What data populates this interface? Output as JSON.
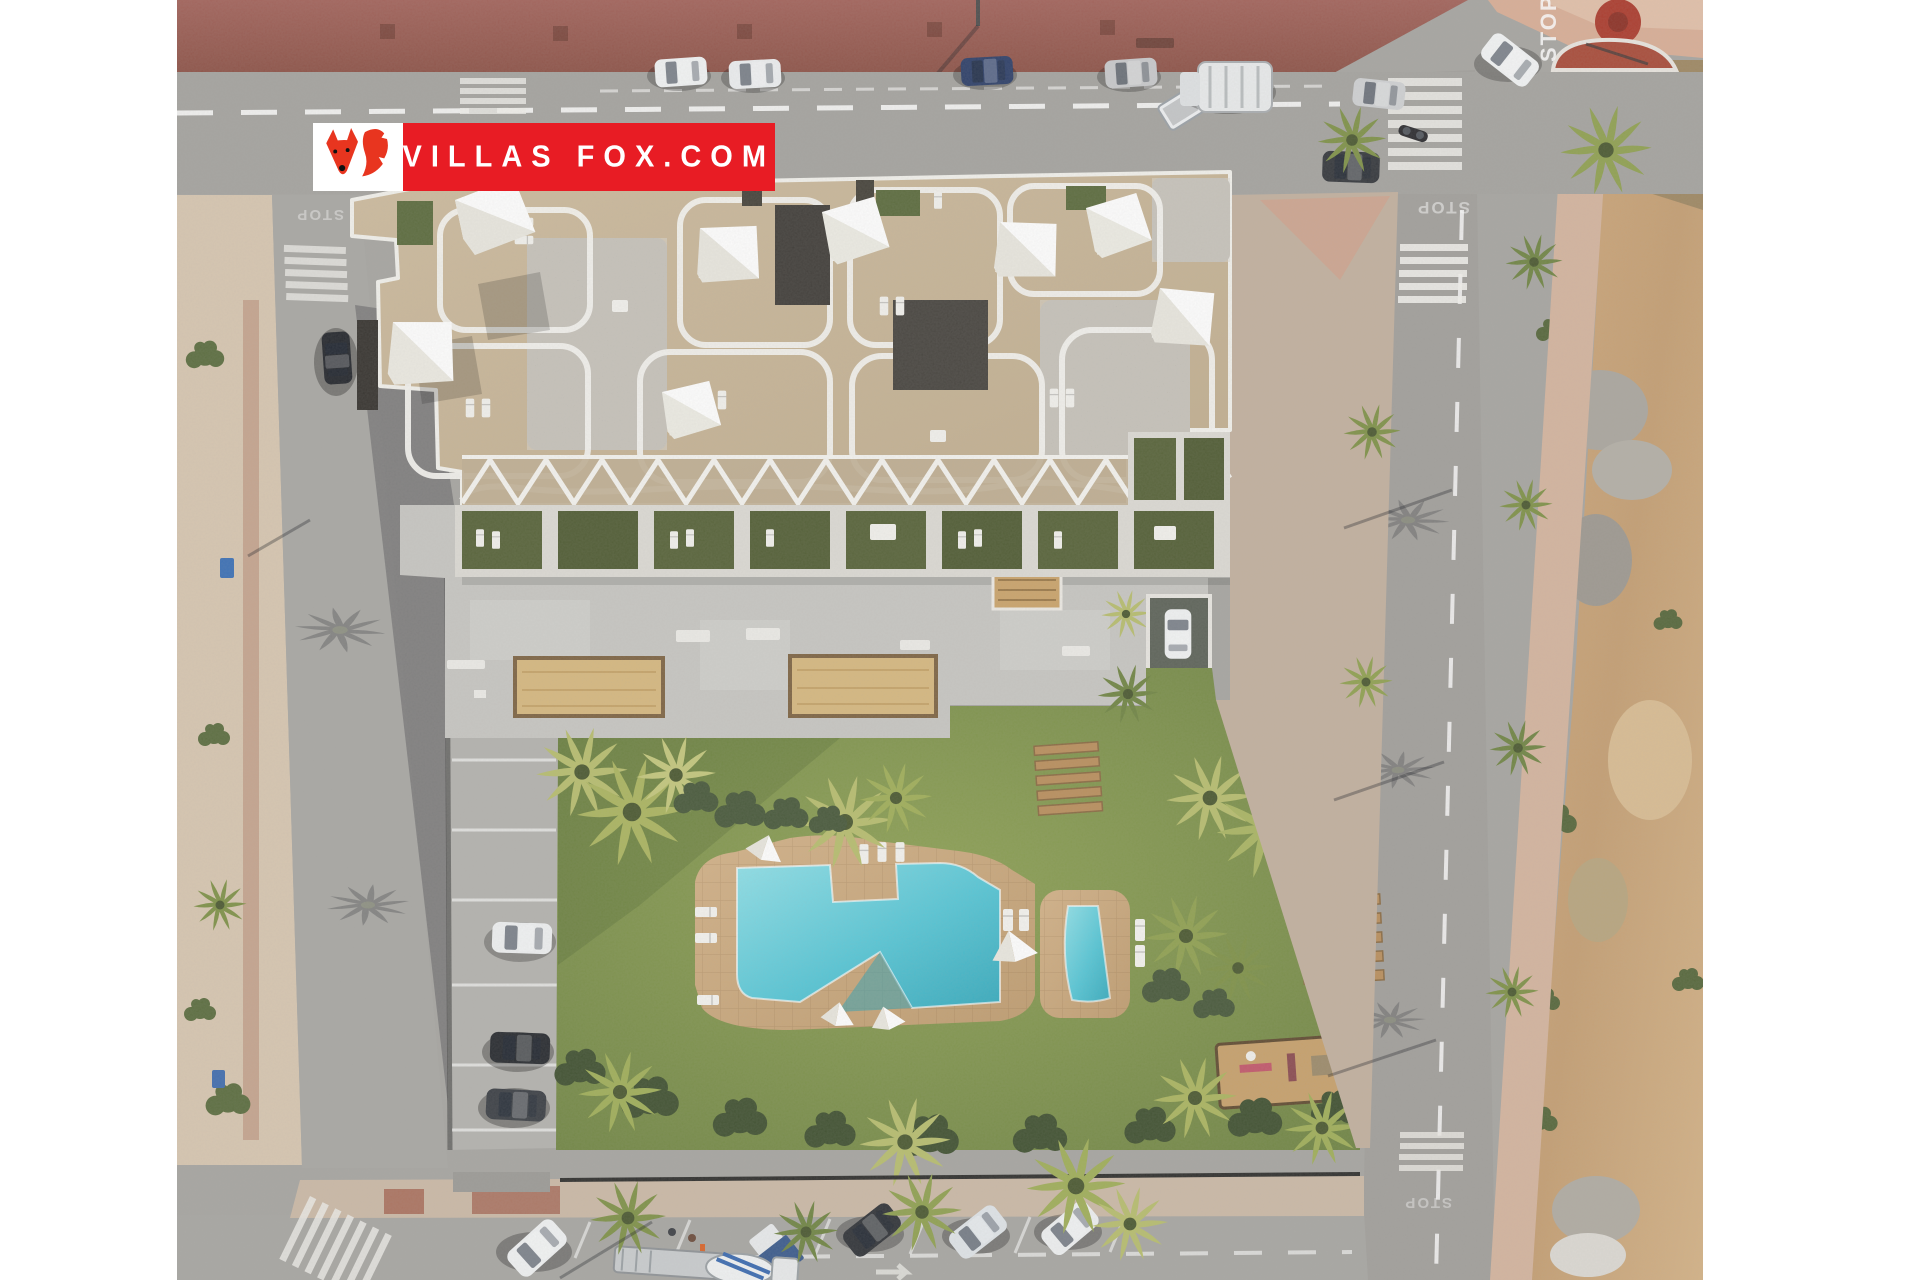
{
  "logo": {
    "brand_text": "VILLAS FOX.COM",
    "brand_color": "#e81c24",
    "icon": "fox-logo-icon"
  },
  "road_markings": {
    "stop": "STOP"
  },
  "scene": {
    "type": "aerial-3d-render",
    "subject": "new-build apartment complex with communal pool, garden, petanque courts, parking and surrounding streets",
    "regions": [
      "apartment-building",
      "roof-terraces",
      "sun-sails",
      "ground-floor-terraces",
      "communal-deck",
      "petanque-courts",
      "communal-garden",
      "main-swimming-pool",
      "kids-pool",
      "sun-loungers",
      "wooden-benches",
      "outdoor-gym",
      "parking-lane",
      "top-road",
      "left-road",
      "right-road",
      "bottom-road",
      "crosswalks",
      "construction-plot",
      "palm-trees"
    ],
    "colors": {
      "pool_water": "#4fc4d4",
      "lawn": "#7c8f4e",
      "roof_stone": "#c9b79a",
      "sidewalk_red": "#9a5b4e",
      "dirt": "#c8a377",
      "asphalt": "#a4a39f"
    }
  }
}
